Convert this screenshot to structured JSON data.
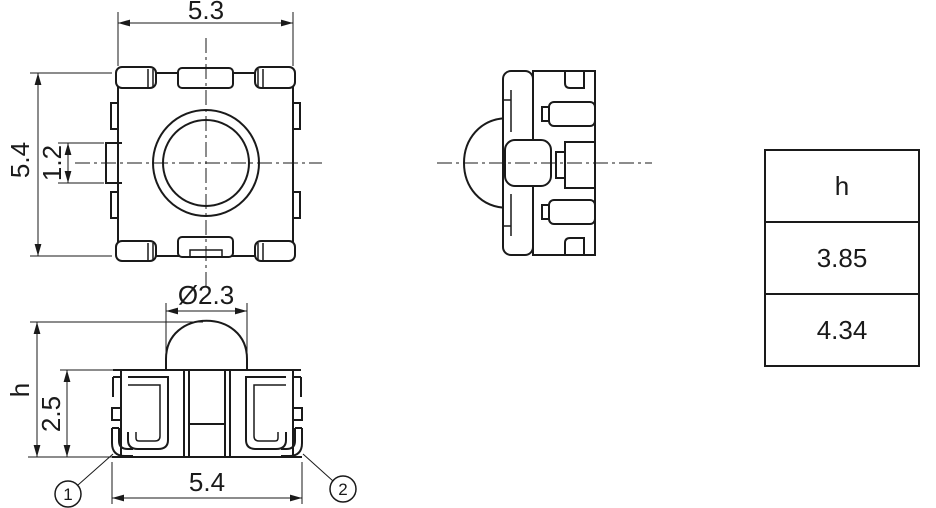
{
  "colors": {
    "line": "#1a1a1a",
    "background": "#ffffff"
  },
  "top_view": {
    "width": "5.3",
    "height": "5.4",
    "stem_width": "1.2"
  },
  "front_view": {
    "button_diameter": "Ø2.3",
    "total_height": "h",
    "body_height": "2.5",
    "base_width": "5.4",
    "callout_1": "1",
    "callout_2": "2"
  },
  "table": {
    "header": "h",
    "rows": [
      "3.85",
      "4.34"
    ]
  }
}
